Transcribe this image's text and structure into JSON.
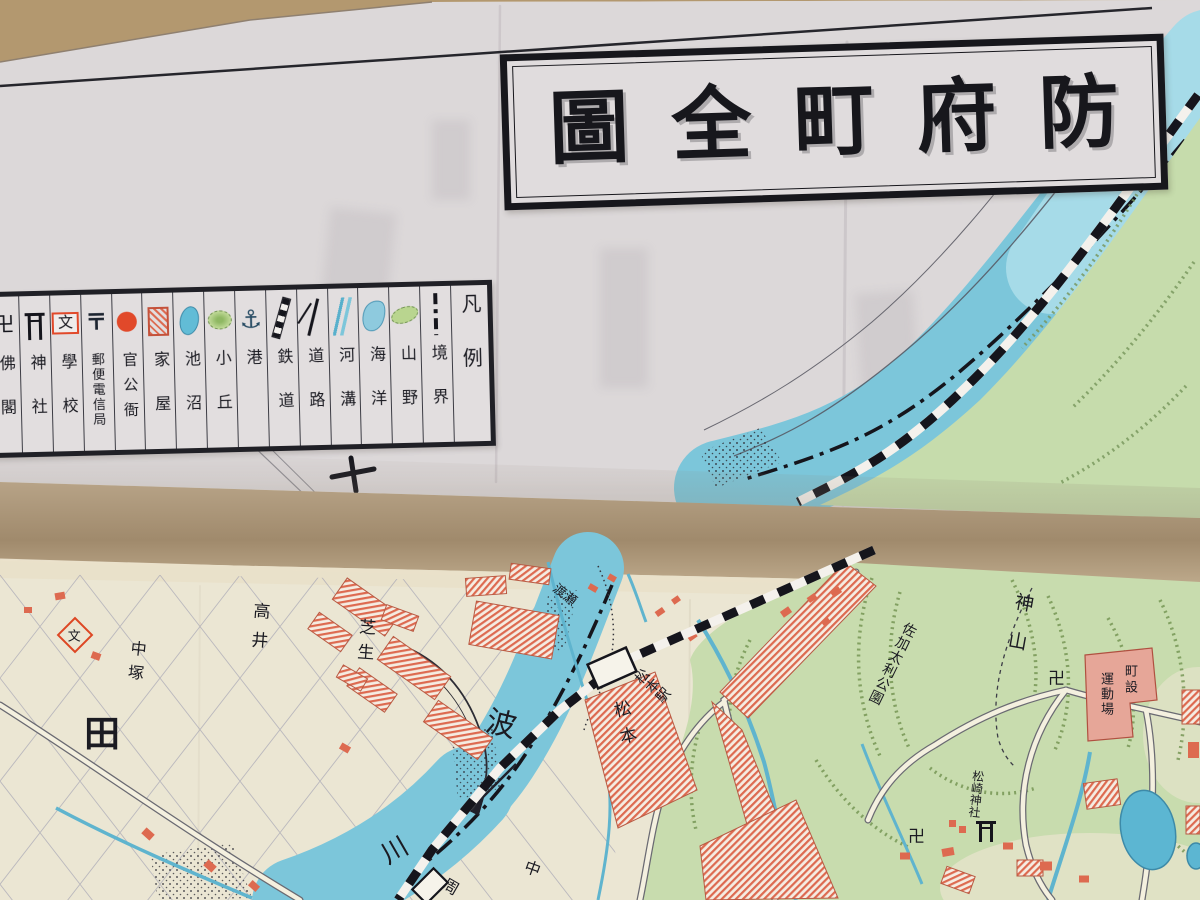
{
  "photo": {
    "description": "Folded antique Japanese town map photographed on a tan table",
    "background_color": "#b3986f",
    "paper_upper_color": "#dcd8d9",
    "paper_lower_color": "#ebe6d3",
    "fold_band_color": "#ab9578"
  },
  "title": {
    "text": "防府町全圖",
    "reading_direction": "right-to-left",
    "chars": [
      "防",
      "府",
      "町",
      "全",
      "圖"
    ]
  },
  "legend": {
    "heading": "凡例",
    "items": [
      {
        "label": "境界",
        "symbol": "boundary-dashdot-line",
        "symbol_class": "sym sym-boundary",
        "label_class": "lcell s2"
      },
      {
        "label": "山野",
        "symbol": "green-hachure-patch",
        "symbol_class": "sym sym-hillpatch",
        "label_class": "lcell s2"
      },
      {
        "label": "海洋",
        "symbol": "blue-sea-patch",
        "symbol_class": "sym sym-sea",
        "label_class": "lcell s2"
      },
      {
        "label": "河溝",
        "symbol": "blue-river-lines",
        "symbol_class": "sym sym-riverlines",
        "label_class": "lcell s2"
      },
      {
        "label": "道路",
        "symbol": "forked-road-lines",
        "symbol_class": "sym sym-roadfork",
        "label_class": "lcell s2"
      },
      {
        "label": "鉄道",
        "symbol": "banded-railway-bar",
        "symbol_class": "sym sym-rail",
        "label_class": "lcell s2"
      },
      {
        "label": "港",
        "symbol": "anchor",
        "symbol_class": "sym sym-anchor",
        "label_class": "lcell s1",
        "glyph": "⚓"
      },
      {
        "label": "小丘",
        "symbol": "green-knoll",
        "symbol_class": "sym sym-knoll",
        "label_class": "lcell s2"
      },
      {
        "label": "池沼",
        "symbol": "blue-pond-ellipse",
        "symbol_class": "sym sym-pond",
        "label_class": "lcell s2"
      },
      {
        "label": "家屋",
        "symbol": "red-hatched-square",
        "symbol_class": "sym sym-house",
        "label_class": "lcell s2"
      },
      {
        "label": "官公衙",
        "symbol": "red-circle",
        "symbol_class": "sym sym-gov",
        "label_class": "lcell s3"
      },
      {
        "label": "郵便電信局",
        "symbol": "postal-mark",
        "symbol_class": "sym sym-post",
        "label_class": "lcell s5",
        "glyph": "〒"
      },
      {
        "label": "學校",
        "symbol": "bun-in-red-box",
        "symbol_class": "sym sym-school",
        "label_class": "lcell s2",
        "glyph": "文"
      },
      {
        "label": "神社",
        "symbol": "torii-gate",
        "symbol_class": "sym sym-torii",
        "label_class": "lcell s2"
      },
      {
        "label": "佛閣",
        "symbol": "manji",
        "symbol_class": "sym sym-manji",
        "label_class": "lcell s2",
        "glyph": "卍"
      }
    ]
  },
  "labels": [
    {
      "text": "田"
    },
    {
      "text": "中塚"
    },
    {
      "text": "高井"
    },
    {
      "text": "芝生"
    },
    {
      "text": "波"
    },
    {
      "text": "川"
    },
    {
      "text": "渡瀬"
    },
    {
      "text": "松本駅"
    },
    {
      "text": "松本"
    },
    {
      "text": "中"
    },
    {
      "text": "周"
    },
    {
      "text": "神山"
    },
    {
      "text": "佐加太利公園"
    },
    {
      "text": "町設"
    },
    {
      "text": "運動場"
    },
    {
      "text": "卍"
    },
    {
      "text": "卍"
    },
    {
      "text": "松崎神社"
    },
    {
      "text": "文"
    }
  ],
  "map_colors": {
    "river_blue": "#7cc6da",
    "river_light_blue": "#a6dbe8",
    "pond_blue": "#5cb6d2",
    "hill_green": "#c8dcae",
    "hachure_green": "#71924f",
    "building_red": "#dd6a50",
    "playground_pink": "#e6a698",
    "ink_black": "#1a1a21",
    "road_fill": "#f4f0df"
  }
}
